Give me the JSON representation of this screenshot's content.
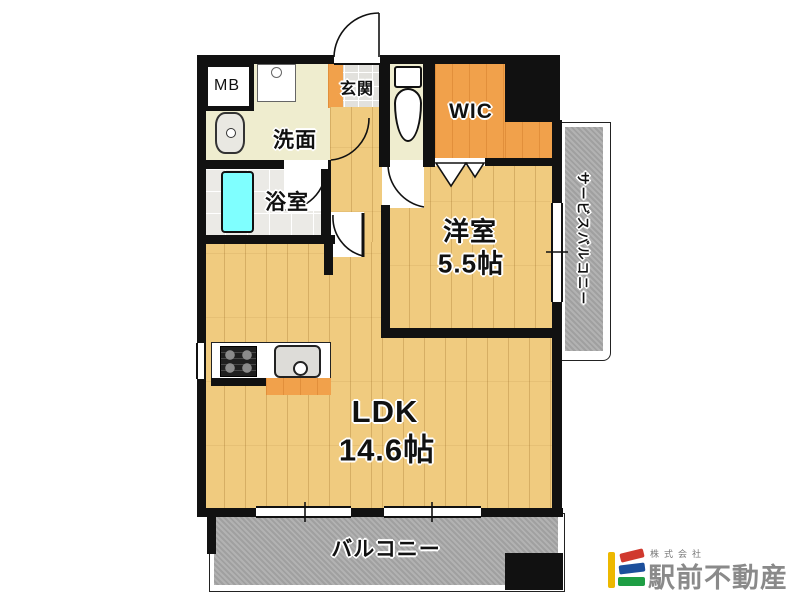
{
  "rooms": {
    "meter_box": "MB",
    "entrance": "玄関",
    "washroom": "洗面",
    "bathroom": "浴室",
    "walk_in_closet": "WIC",
    "western_room": "洋室",
    "western_room_size": "5.5帖",
    "ldk": "LDK",
    "ldk_size": "14.6帖",
    "balcony": "バルコニー",
    "service_balcony": "サービスバルコニー"
  },
  "logo": {
    "company_prefix": "株式会社",
    "company_name": "駅前不動産",
    "mark_bar_color": "#EDB800",
    "mark_top_color": "#D0392E",
    "mark_middle_color": "#1C4F9C",
    "mark_bottom_color": "#1E9E44",
    "text_color": "#8A8A8A"
  },
  "colors": {
    "wall": "#111111",
    "wood_floor": "#F0CB7F",
    "closet_orange": "#F1A14B",
    "cream_floor": "#EFEDCF",
    "entrance_tile": "#E2E1DD",
    "bath_tile": "#EBEAE6",
    "bathtub": "#7FFFFF",
    "balcony_gray": "#ACACAC"
  }
}
